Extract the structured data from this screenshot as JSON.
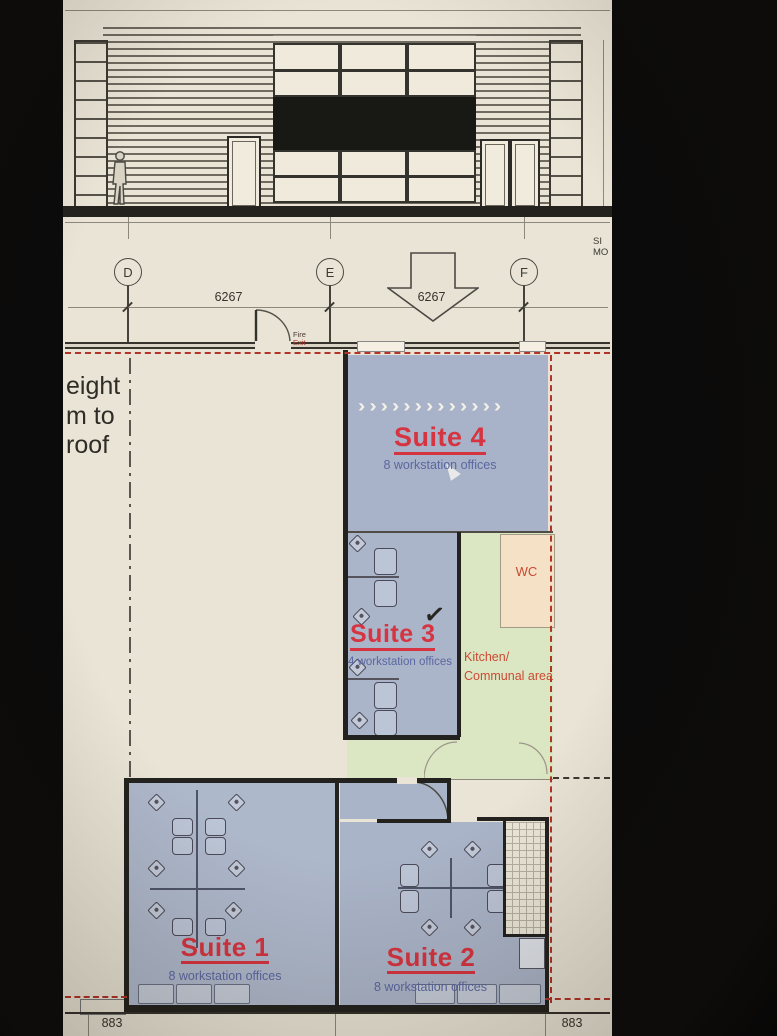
{
  "grid": {
    "d": "D",
    "e": "E",
    "f": "F",
    "dim_left": "6267",
    "dim_right": "6267"
  },
  "margin_note": {
    "line1": "SI",
    "line2": "MO"
  },
  "fire_exit": {
    "line1": "Fire",
    "line2": "Exit"
  },
  "height_note": {
    "line1": "eight",
    "line2": "m to",
    "line3": "roof"
  },
  "suites": {
    "s4": {
      "name": "Suite 4",
      "desc": "8 workstation offices"
    },
    "s3": {
      "name": "Suite 3",
      "desc": "4 workstation offices"
    },
    "s1": {
      "name": "Suite 1",
      "desc": "8 workstation offices"
    },
    "s2": {
      "name": "Suite 2",
      "desc": "8 workstation offices"
    }
  },
  "rooms": {
    "wc": "WC",
    "kitchen_line1": "Kitchen/",
    "kitchen_line2": "Communal area"
  },
  "bottom_dims": {
    "left": "883",
    "right": "883"
  },
  "glyphs": {
    "chevrons": "›››››››››››››",
    "check": "✓"
  },
  "colors": {
    "suite_fill": "#aab4c8",
    "kitchen_green": "#dbe6c3",
    "wc_peach": "#f5e1c5",
    "suite_red": "#d53440",
    "label_blue": "#5b67a0",
    "boundary_red": "#b23327",
    "paper": "#e9e4d5",
    "wall": "#23221e"
  }
}
